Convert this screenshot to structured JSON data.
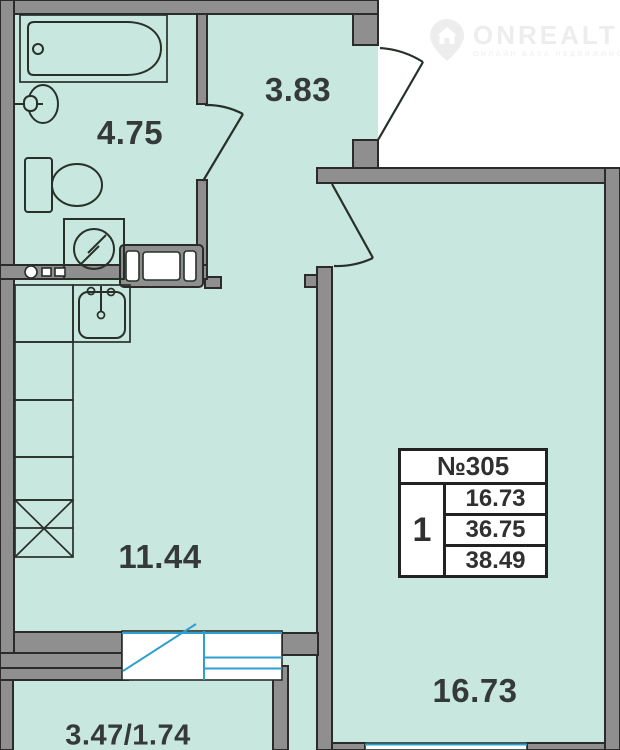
{
  "page": {
    "type": "apartment-floor-plan"
  },
  "logo": {
    "brand": "ONREALT",
    "tagline": "ОНЛАЙН БАЗА НЕДВИЖИМОСТИ"
  },
  "rooms": {
    "bathroom": {
      "area": "4.75"
    },
    "hallway": {
      "area": "3.83"
    },
    "kitchen": {
      "area": "11.44"
    },
    "living_room": {
      "area": "16.73"
    },
    "balcony": {
      "area": "3.47/1.74"
    }
  },
  "info_table": {
    "apartment_number": "№305",
    "room_count": "1",
    "rows": [
      "16.73",
      "36.75",
      "38.49"
    ]
  },
  "fixtures": [
    "bathtub",
    "wash-basin",
    "toilet",
    "washing-machine",
    "vent-shaft",
    "kitchen-sink",
    "kitchen-counter",
    "wardrobe",
    "balcony-door-window",
    "room-window",
    "entrance-door",
    "bathroom-door",
    "room-door"
  ],
  "colors": {
    "floor": "#c8e7de",
    "wall_fill": "#8f8f8f",
    "wall_stroke": "#2b2b2b",
    "fixture_line": "#273029",
    "window_blue": "#2e9fd0",
    "label_text": "#353a38",
    "table_bg": "#ffffff",
    "logo_gray": "#ededed"
  }
}
